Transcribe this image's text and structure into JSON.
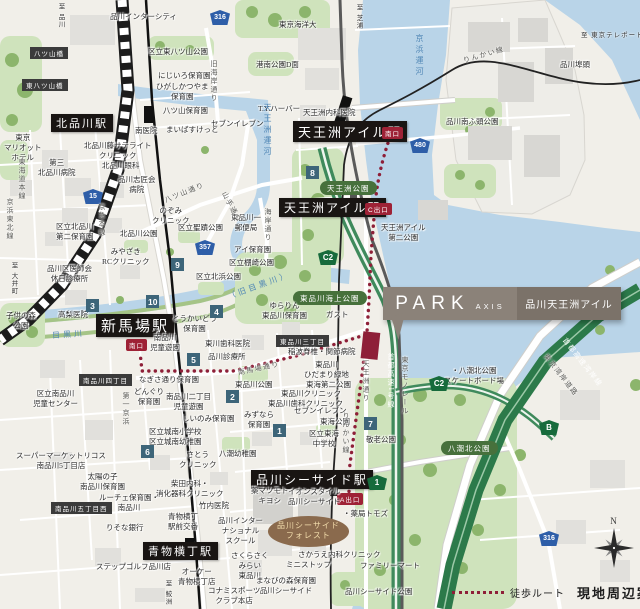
{
  "legend": {
    "walk_route": "徒歩ルート",
    "title": "現地周辺案内図"
  },
  "compass": {
    "north": "N"
  },
  "property": {
    "brand": "PARK",
    "brand_sub": "AXIS",
    "name": "品川天王洲アイル"
  },
  "colors": {
    "route": "#8e1f38",
    "water": "#b9d4e8",
    "park_green": "#c9ddb2",
    "expressway_green": "#2c7a4a",
    "station_bg": "#191513",
    "exit_red": "#9e2236",
    "badge_teal": "#3d6579",
    "shield_blue": "#2e5ea8",
    "shield_green": "#176b3c",
    "callout_bg": "#8b8279"
  },
  "map": {
    "stations": [
      {
        "x": 51,
        "y": 114,
        "t": "北品川駅",
        "fs": 11
      },
      {
        "x": 293,
        "y": 121,
        "t": "天王洲アイル駅",
        "fs": 13
      },
      {
        "x": 279,
        "y": 198,
        "t": "天王洲アイル駅",
        "fs": 12
      },
      {
        "x": 96,
        "y": 314,
        "t": "新馬場駅",
        "fs": 15
      },
      {
        "x": 251,
        "y": 470,
        "t": "品川シーサイド駅",
        "fs": 12
      },
      {
        "x": 143,
        "y": 542,
        "t": "青物横丁駅",
        "fs": 11
      }
    ],
    "exits": [
      {
        "x": 382,
        "y": 127,
        "t": "南口"
      },
      {
        "x": 365,
        "y": 203,
        "t": "C出口"
      },
      {
        "x": 126,
        "y": 339,
        "t": "南口"
      },
      {
        "x": 337,
        "y": 493,
        "t": "A出口"
      }
    ],
    "park_labels": [
      {
        "x": 320,
        "y": 181,
        "t": "天王洲公園"
      },
      {
        "x": 293,
        "y": 291,
        "t": "東品川海上公園"
      },
      {
        "x": 441,
        "y": 441,
        "t": "八潮北公園"
      }
    ],
    "area_labels": [
      {
        "x": 30,
        "y": 47,
        "t": "八ツ山橋"
      },
      {
        "x": 22,
        "y": 79,
        "t": "東八ツ山橋"
      },
      {
        "x": 79,
        "y": 374,
        "t": "南品川四丁目"
      },
      {
        "x": 276,
        "y": 335,
        "t": "東品川三丁目"
      },
      {
        "x": 51,
        "y": 502,
        "t": "南品川五丁目西"
      }
    ],
    "oval_labels": [
      {
        "x": 268,
        "y": 516,
        "t": "品川シーサイド\nフォレスト"
      }
    ],
    "badges": [
      {
        "x": 273,
        "y": 424,
        "t": "1"
      },
      {
        "x": 226,
        "y": 390,
        "t": "2"
      },
      {
        "x": 86,
        "y": 299,
        "t": "3"
      },
      {
        "x": 210,
        "y": 305,
        "t": "4"
      },
      {
        "x": 187,
        "y": 353,
        "t": "5"
      },
      {
        "x": 141,
        "y": 445,
        "t": "6"
      },
      {
        "x": 364,
        "y": 417,
        "t": "7"
      },
      {
        "x": 306,
        "y": 166,
        "t": "8"
      },
      {
        "x": 171,
        "y": 258,
        "t": "9"
      },
      {
        "x": 146,
        "y": 295,
        "t": "10"
      }
    ],
    "shields": [
      {
        "x": 210,
        "y": 10,
        "t": "316",
        "k": "blue"
      },
      {
        "x": 83,
        "y": 189,
        "t": "15",
        "k": "blue"
      },
      {
        "x": 195,
        "y": 240,
        "t": "357",
        "k": "blue"
      },
      {
        "x": 410,
        "y": 138,
        "t": "480",
        "k": "blue"
      },
      {
        "x": 539,
        "y": 531,
        "t": "316",
        "k": "blue"
      },
      {
        "x": 318,
        "y": 250,
        "t": "C2",
        "k": "green"
      },
      {
        "x": 429,
        "y": 376,
        "t": "C2",
        "k": "green"
      },
      {
        "x": 539,
        "y": 420,
        "t": "B",
        "k": "green"
      },
      {
        "x": 367,
        "y": 475,
        "t": "1",
        "k": "green"
      }
    ],
    "water_labels": [
      {
        "x": 262,
        "y": 103,
        "t": "天王洲運河",
        "v": true
      },
      {
        "x": 414,
        "y": 34,
        "t": "京浜運河",
        "v": true
      },
      {
        "x": 52,
        "y": 329,
        "t": "目黒川",
        "r": -4
      },
      {
        "x": 226,
        "y": 280,
        "t": "（旧目黒川）",
        "r": -20
      }
    ],
    "road_labels": [
      {
        "x": 209,
        "y": 60,
        "t": "旧海岸通り",
        "v": true
      },
      {
        "x": 163,
        "y": 196,
        "t": "八ツ山通り",
        "r": -22
      },
      {
        "x": 228,
        "y": 190,
        "t": "山手通り",
        "r": 62
      },
      {
        "x": 263,
        "y": 208,
        "t": "海岸通り",
        "v": true
      },
      {
        "x": 237,
        "y": 368,
        "t": "南馬場通り",
        "r": -12
      },
      {
        "x": 121,
        "y": 392,
        "t": "第一京浜",
        "v": true
      },
      {
        "x": 361,
        "y": 360,
        "t": "天王洲通り",
        "v": true
      },
      {
        "x": 386,
        "y": 353,
        "t": "首都高速1号線",
        "v": true,
        "l": true
      },
      {
        "x": 400,
        "y": 356,
        "t": "東京モノレール",
        "v": true
      },
      {
        "x": 568,
        "y": 336,
        "t": "首都高速湾岸線",
        "r": 52,
        "l": true
      },
      {
        "x": 549,
        "y": 352,
        "t": "東京湾岸道路",
        "r": 52
      },
      {
        "x": 462,
        "y": 56,
        "t": "りんかい線",
        "r": -16
      },
      {
        "x": 341,
        "y": 412,
        "t": "りんかい線",
        "v": true
      },
      {
        "x": 97,
        "y": 203,
        "t": "京急本線",
        "v": true
      },
      {
        "x": 17,
        "y": 158,
        "t": "東海道本線",
        "v": true
      },
      {
        "x": 5,
        "y": 198,
        "t": "京浜東北線",
        "v": true
      }
    ],
    "directions": [
      {
        "x": 55,
        "y": 3,
        "t": "至 品川",
        "v": true
      },
      {
        "x": 353,
        "y": 4,
        "t": "至 芝浦",
        "v": true
      },
      {
        "x": 581,
        "y": 29,
        "t": "至 東京テレポート"
      },
      {
        "x": 8,
        "y": 262,
        "t": "至 大井町",
        "v": true
      },
      {
        "x": 162,
        "y": 580,
        "t": "至 鮫洲",
        "v": true
      }
    ],
    "facilities": [
      {
        "x": 110,
        "y": 12,
        "t": "品川インターシティ"
      },
      {
        "x": 148,
        "y": 47,
        "t": "区立東八ツ山公園"
      },
      {
        "x": 158,
        "y": 71,
        "t": "にじいろ保育園"
      },
      {
        "x": 156,
        "y": 82,
        "t": "ひがしかつやま\n保育園"
      },
      {
        "x": 163,
        "y": 106,
        "t": "八ツ山保育園"
      },
      {
        "x": 135,
        "y": 126,
        "t": "南医院"
      },
      {
        "x": 166,
        "y": 125,
        "t": "まいばすけっと"
      },
      {
        "x": 211,
        "y": 119,
        "t": "セブンイレブン"
      },
      {
        "x": 258,
        "y": 104,
        "t": "T.Y.ハーバー"
      },
      {
        "x": 279,
        "y": 20,
        "t": "東京海洋大"
      },
      {
        "x": 256,
        "y": 60,
        "t": "港南公園D面"
      },
      {
        "x": 84,
        "y": 141,
        "t": "北品川藤サテライト\nクリニック"
      },
      {
        "x": 4,
        "y": 133,
        "t": "東京\nマリオット\nホテル"
      },
      {
        "x": 303,
        "y": 108,
        "t": "天王洲内科医院"
      },
      {
        "x": 560,
        "y": 60,
        "t": "品川埠頭"
      },
      {
        "x": 446,
        "y": 117,
        "t": "品川南ふ頭公園"
      },
      {
        "x": 38,
        "y": 158,
        "t": "第三\n北品川病院"
      },
      {
        "x": 102,
        "y": 161,
        "t": "北品川眼科"
      },
      {
        "x": 118,
        "y": 175,
        "t": "品川志匠会\n病院"
      },
      {
        "x": 152,
        "y": 206,
        "t": "のぞみ\nクリニック"
      },
      {
        "x": 178,
        "y": 223,
        "t": "区立聖蹟公園"
      },
      {
        "x": 231,
        "y": 213,
        "t": "東品川一\n郵便局"
      },
      {
        "x": 234,
        "y": 245,
        "t": "アイ保育園"
      },
      {
        "x": 56,
        "y": 222,
        "t": "区立北品川\n第二保育園"
      },
      {
        "x": 120,
        "y": 229,
        "t": "北品川公園"
      },
      {
        "x": 102,
        "y": 247,
        "t": "みやざき\nRCクリニック"
      },
      {
        "x": 47,
        "y": 264,
        "t": "品川区医師会\n休日診療所"
      },
      {
        "x": 196,
        "y": 272,
        "t": "区立北浜公園"
      },
      {
        "x": 229,
        "y": 258,
        "t": "区立棚崎公園"
      },
      {
        "x": 58,
        "y": 310,
        "t": "高梨医院"
      },
      {
        "x": 6,
        "y": 311,
        "t": "子供の森\n公園"
      },
      {
        "x": 262,
        "y": 301,
        "t": "ゆらりん\n東品川保育園"
      },
      {
        "x": 172,
        "y": 314,
        "t": "とうかいどう\n保育園"
      },
      {
        "x": 150,
        "y": 333,
        "t": "南品川\n児童遊園"
      },
      {
        "x": 205,
        "y": 339,
        "t": "東川歯科医院"
      },
      {
        "x": 208,
        "y": 352,
        "t": "品川診療所"
      },
      {
        "x": 288,
        "y": 347,
        "t": "稲波脊椎・関節病院"
      },
      {
        "x": 304,
        "y": 360,
        "t": "東品川\nひだまり緑地"
      },
      {
        "x": 306,
        "y": 380,
        "t": "東海第二公園"
      },
      {
        "x": 235,
        "y": 380,
        "t": "東品川公園"
      },
      {
        "x": 281,
        "y": 389,
        "t": "東品川クリニック"
      },
      {
        "x": 268,
        "y": 399,
        "t": "東品川歯科クリニック"
      },
      {
        "x": 294,
        "y": 406,
        "t": "セブンイレブン"
      },
      {
        "x": 244,
        "y": 410,
        "t": "みずなら\n保育園"
      },
      {
        "x": 139,
        "y": 375,
        "t": "なぎさ通り保育園"
      },
      {
        "x": 134,
        "y": 387,
        "t": "どんぐり\n保育園"
      },
      {
        "x": 166,
        "y": 392,
        "t": "南品川二丁目\n児童遊園"
      },
      {
        "x": 33,
        "y": 389,
        "t": "区立南品川\n児童センター"
      },
      {
        "x": 182,
        "y": 414,
        "t": "しいのみ保育園"
      },
      {
        "x": 149,
        "y": 427,
        "t": "区立城南小学校\n区立城南幼稚園"
      },
      {
        "x": 381,
        "y": 223,
        "t": "天王洲アイル\n第二公園"
      },
      {
        "x": 326,
        "y": 310,
        "t": "ガスト"
      },
      {
        "x": 444,
        "y": 366,
        "t": "・八潮北公園\nスケートボード場"
      },
      {
        "x": 366,
        "y": 435,
        "t": "敬老公園"
      },
      {
        "x": 343,
        "y": 509,
        "t": "・薬局トモズ"
      },
      {
        "x": 360,
        "y": 561,
        "t": "ファミリーマート"
      },
      {
        "x": 345,
        "y": 587,
        "t": "品川シーサイド公園"
      },
      {
        "x": 320,
        "y": 417,
        "t": "東海公園"
      },
      {
        "x": 309,
        "y": 429,
        "t": "区立東海\n中学校"
      },
      {
        "x": 16,
        "y": 451,
        "t": "スーパーマーケットリコス\n南品川5丁目店"
      },
      {
        "x": 80,
        "y": 472,
        "t": "太陽の子\n南品川保育園"
      },
      {
        "x": 99,
        "y": 493,
        "t": "ルーチェ保育園・\n南品川"
      },
      {
        "x": 106,
        "y": 523,
        "t": "りそな銀行"
      },
      {
        "x": 168,
        "y": 512,
        "t": "青物横丁\n駅前交番"
      },
      {
        "x": 96,
        "y": 562,
        "t": "ステップゴルフ品川店"
      },
      {
        "x": 178,
        "y": 567,
        "t": "オーケー\n青物横丁店"
      },
      {
        "x": 179,
        "y": 450,
        "t": "さとう\nクリニック"
      },
      {
        "x": 219,
        "y": 449,
        "t": "八潮幼稚園"
      },
      {
        "x": 156,
        "y": 479,
        "t": "柴田内科・\n消化器科クリニック"
      },
      {
        "x": 199,
        "y": 501,
        "t": "竹内医院"
      },
      {
        "x": 218,
        "y": 516,
        "t": "品川インター\nナショナル\nスクール"
      },
      {
        "x": 231,
        "y": 551,
        "t": "さくらさく\nみらい\n東品川"
      },
      {
        "x": 251,
        "y": 486,
        "t": "薬マツモト\nキヨシ"
      },
      {
        "x": 288,
        "y": 487,
        "t": "イオンスタイル\n品川シーサイド"
      },
      {
        "x": 298,
        "y": 550,
        "t": "さかうえ内科クリニック"
      },
      {
        "x": 286,
        "y": 560,
        "t": "ミニストップ"
      },
      {
        "x": 256,
        "y": 576,
        "t": "まなびの森保育園\n品川シーサイド"
      },
      {
        "x": 208,
        "y": 586,
        "t": "コナミスポーツ\nクラブ本店"
      }
    ]
  }
}
